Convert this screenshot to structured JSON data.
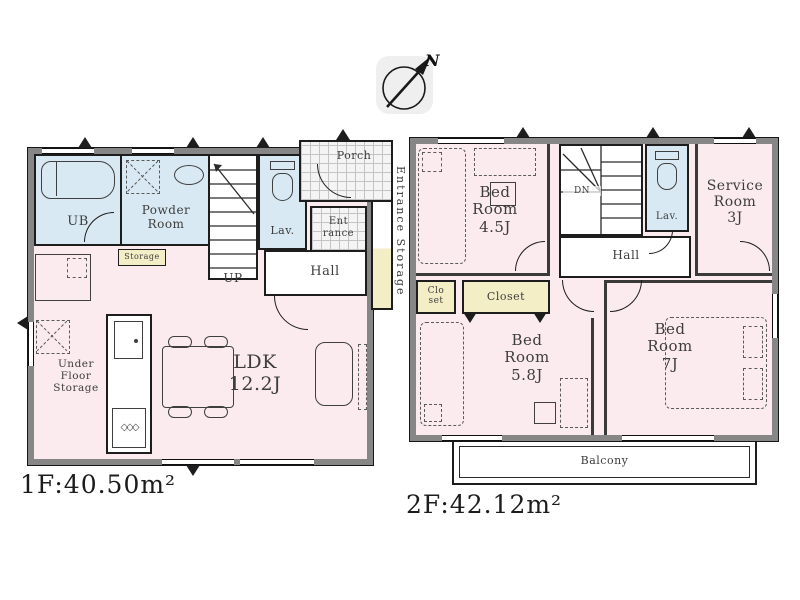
{
  "compass": {
    "north": "N"
  },
  "floor1": {
    "area": "1F:40.50m²",
    "ub": "UB",
    "powder_room": "Powder\nRoom",
    "storage": "Storage",
    "up": "UP",
    "lav": "Lav.",
    "porch": "Porch",
    "entrance": "Ent\nrance",
    "hall": "Hall",
    "entrance_storage": "Entrance Storage",
    "ldk": "LDK\n12.2J",
    "under_floor_storage": "Under\nFloor\nStorage"
  },
  "floor2": {
    "area": "2F:42.12m²",
    "bedroom_45": "Bed\nRoom\n4.5J",
    "dn": "DN",
    "lav": "Lav.",
    "service_room": "Service\nRoom\n3J",
    "hall": "Hall",
    "closet_small": "Clo\nset",
    "closet": "Closet",
    "bedroom_58": "Bed\nRoom\n5.8J",
    "bedroom_7": "Bed\nRoom\n7J",
    "balcony": "Balcony"
  },
  "icons": {
    "stove_burners": "◇◇◇"
  },
  "colors": {
    "room_pink": "#fbebef",
    "wet_blue": "#d9e9f3",
    "closet_yellow": "#f4eec6",
    "wall_gray": "#868686"
  }
}
